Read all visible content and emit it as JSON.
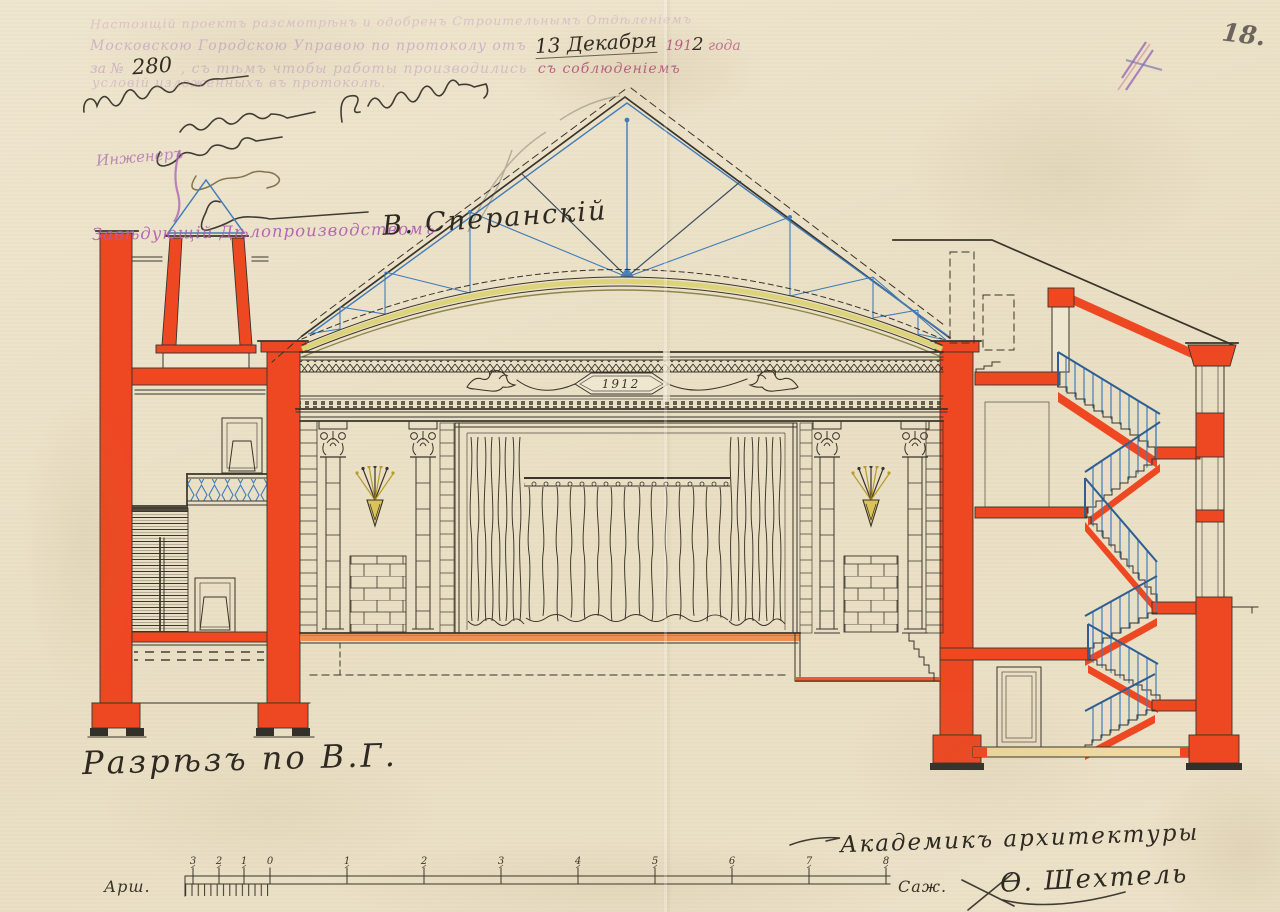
{
  "document": {
    "stamp": {
      "line1": "Настоящій проектъ разсмотрѣнъ и одобренъ Строительнымъ Отдѣленіемъ",
      "line2_prefix": "Московскою Городскою Управою по протоколу отъ",
      "date_handwritten": "13 Декабря",
      "year_printed": "191",
      "year_handwritten": "2",
      "year_suffix": "года",
      "line3_prefix": "за №",
      "number_handwritten": "280",
      "line3_body": ", съ тѣмъ чтобы работы производились",
      "line3_emphasis": "съ соблюденіемъ",
      "line4": "условій изложенныхъ въ протоколѣ."
    },
    "officials": {
      "inspector_label": "Инженеръ",
      "records_label": "Завѣдующій Дѣлопроизводствомъ",
      "records_signature": "В. Сперанскій"
    },
    "page_number": "18.",
    "title": "Разрѣзъ по В.Г.",
    "architect": {
      "title": "Академикъ архитектуры",
      "signature": "Ѳ. Шехтель"
    },
    "cartouche_year": "1912"
  },
  "scalebar": {
    "left_label": "Арш.",
    "right_label": "Саж.",
    "arshin_ticks": [
      "3",
      "2",
      "1",
      "0"
    ],
    "sazhen_ticks": [
      "1",
      "2",
      "3",
      "4",
      "5",
      "6",
      "7",
      "8"
    ]
  },
  "colors": {
    "paper": "#ebe1c8",
    "ink": "#3a342a",
    "red": "#ee4823",
    "blue": "#3f7cba",
    "yellow": "#ddd37a",
    "orange": "#f0823c",
    "purple": "#a662ae",
    "pencil": "#55504a"
  }
}
